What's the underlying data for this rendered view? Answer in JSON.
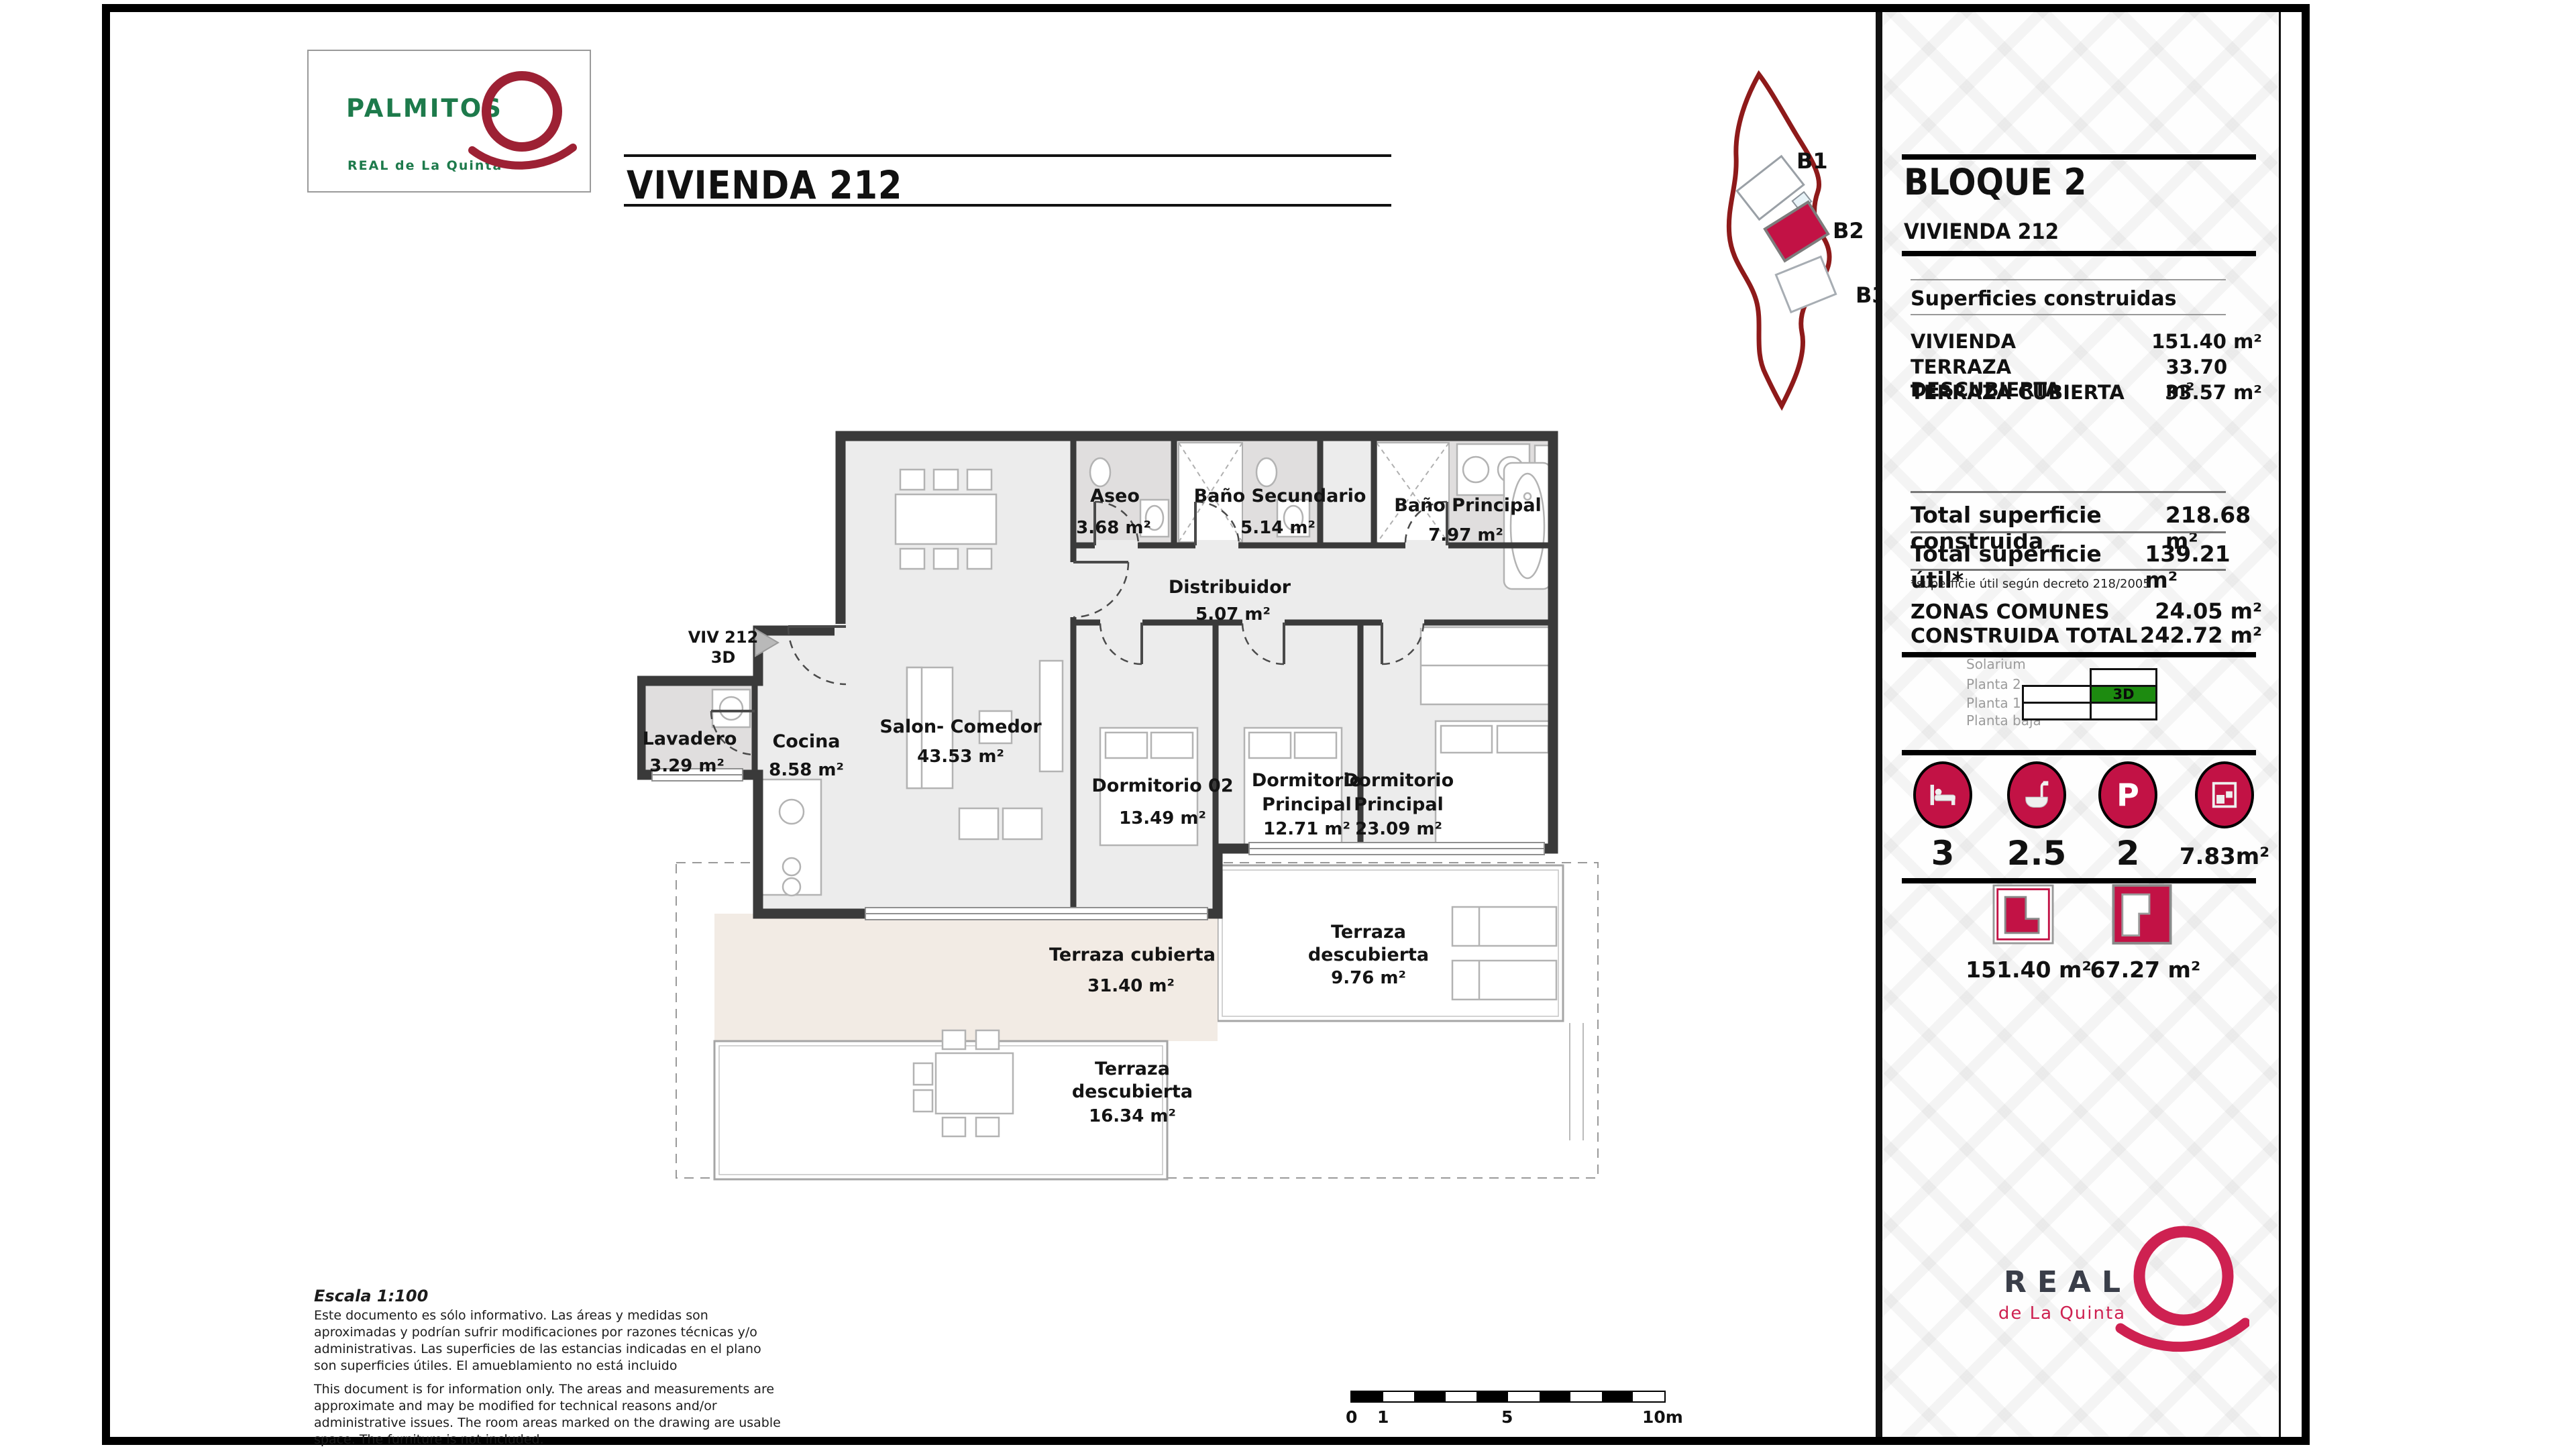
{
  "colors": {
    "accent_crimson": "#c21245",
    "brand_green": "#1d7a4b",
    "brand_crimson": "#ce2151",
    "sitemap_red": "#8e1a1a",
    "active_green": "#1d8b10",
    "wall_gray": "#3a3a3a"
  },
  "header": {
    "brand": "PALMITOS",
    "brand_sub": "REAL de La Quinta",
    "title": "VIVIENDA 212"
  },
  "sitemap": {
    "b1": "B1",
    "b2": "B2",
    "b3": "B3"
  },
  "sidebar": {
    "block_title": "BLOQUE 2",
    "unit_title": "VIVIENDA 212",
    "surfaces_heading": "Superficies construidas",
    "surfaces": [
      {
        "label": "VIVIENDA",
        "value": "151.40 m²"
      },
      {
        "label": "TERRAZA DESCUBIERTA",
        "value": "33.70 m²"
      },
      {
        "label": "TERRAZA CUBIERTA",
        "value": "33.57 m²"
      }
    ],
    "totals": [
      {
        "label": "Total superficie construida",
        "value": "218.68 m²"
      },
      {
        "label": "Total superficie útil*",
        "value": "139.21 m²"
      }
    ],
    "footnote": "*superficie útil según decreto 218/2005",
    "commons": [
      {
        "label": "ZONAS COMUNES",
        "value": "24.05 m²"
      },
      {
        "label": "CONSTRUIDA TOTAL",
        "value": "242.72 m²"
      }
    ],
    "floors": {
      "l0": "Solarium",
      "l1": "Planta 2",
      "l2": "Planta 1",
      "l3": "Planta baja",
      "active": "3D"
    },
    "stats": [
      {
        "icon": "bed-icon",
        "value": "3"
      },
      {
        "icon": "bath-icon",
        "value": "2.5"
      },
      {
        "icon": "parking-icon",
        "value": "2"
      },
      {
        "icon": "storage-icon",
        "value": "7.83m²"
      }
    ],
    "areas": [
      {
        "icon": "interior-plan-icon",
        "value": "151.40 m²"
      },
      {
        "icon": "terrace-plan-icon",
        "value": "67.27 m²"
      }
    ],
    "brand": "REAL",
    "brand_sub": "de La Quinta",
    "parking_letter": "P"
  },
  "plan": {
    "entrance_line1": "VIV 212",
    "entrance_line2": "3D",
    "rooms": {
      "aseo": {
        "name": "Aseo",
        "area": "3.68 m²"
      },
      "bano_sec": {
        "name": "Baño Secundario",
        "area": "5.14 m²"
      },
      "bano_ppal": {
        "name": "Baño Principal",
        "area": "7.97 m²"
      },
      "distribuidor": {
        "name": "Distribuidor",
        "area": "5.07 m²"
      },
      "salon": {
        "name": "Salon- Comedor",
        "area": "43.53 m²"
      },
      "cocina": {
        "name": "Cocina",
        "area": "8.58 m²"
      },
      "lavadero": {
        "name": "Lavadero",
        "area": "3.29 m²"
      },
      "dorm02": {
        "name": "Dormitorio 02",
        "area": "13.49 m²"
      },
      "dorm_ppal_1": {
        "name1": "Dormitorio",
        "name2": "Principal",
        "area": "12.71 m²"
      },
      "dorm_ppal_2": {
        "name1": "Dormitorio",
        "name2": "Principal",
        "area": "23.09 m²"
      },
      "terraza_cubierta": {
        "name": "Terraza cubierta",
        "area": "31.40 m²"
      },
      "terraza_desc_1": {
        "name1": "Terraza",
        "name2": "descubierta",
        "area": "9.76 m²"
      },
      "terraza_desc_2": {
        "name1": "Terraza",
        "name2": "descubierta",
        "area": "16.34 m²"
      }
    }
  },
  "footer": {
    "scale_title": "Escala 1:100",
    "disclaimer_es": "Este documento es sólo informativo. Las áreas y medidas son aproximadas y podrían sufrir modificaciones por razones técnicas y/o administrativas. Las superficies de las estancias indicadas en el plano son superficies útiles. El amueblamiento no está incluido",
    "disclaimer_en": "This document is for information only. The areas and measurements are approximate and may be modified for technical reasons and/or administrative issues. The room areas marked on the drawing are usable space. The furniture is not included.",
    "scalebar": {
      "t0": "0",
      "t1": "1",
      "t2": "5",
      "t3": "10m"
    }
  }
}
